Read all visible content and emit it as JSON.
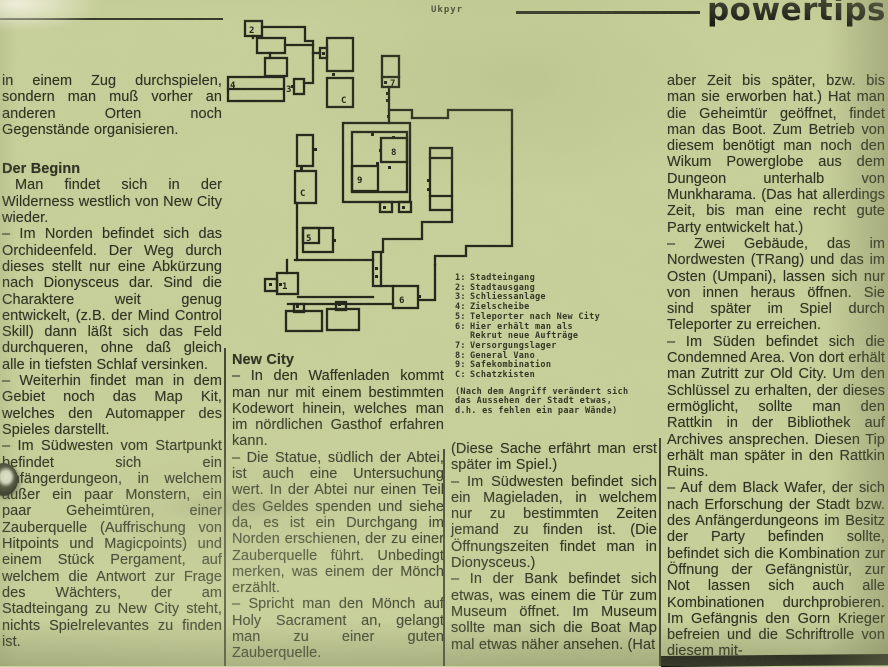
{
  "meta": {
    "map_caption": "Ukpyr",
    "section_title": "powertips"
  },
  "colors": {
    "paper": "#c9d19b",
    "ink": "#23261a",
    "map_ink": "#1b1d12"
  },
  "map": {
    "labels": {
      "r2": "2",
      "r3": "3",
      "r4": "4",
      "c_top": "C",
      "r7": "7",
      "r8": "8",
      "r9": "9",
      "c_mid": "C",
      "r5": "5",
      "r1": "1",
      "r6": "6"
    }
  },
  "legend": {
    "items": [
      {
        "k": "1:",
        "t": "Stadteingang"
      },
      {
        "k": "2:",
        "t": "Stadtausgang"
      },
      {
        "k": "3:",
        "t": "Schliessanlage"
      },
      {
        "k": "4:",
        "t": "Zielscheibe"
      },
      {
        "k": "5:",
        "t": "Teleporter nach New City"
      },
      {
        "k": "6:",
        "t": "Hier erhält man als"
      },
      {
        "k": "",
        "t": "Rekrut neue Aufträge"
      },
      {
        "k": "7:",
        "t": "Versorgungslager"
      },
      {
        "k": "8:",
        "t": "General Vano"
      },
      {
        "k": "9:",
        "t": "Safekombination"
      },
      {
        "k": "C:",
        "t": "Schatzkisten"
      }
    ],
    "note": [
      "(Nach dem Angriff verändert sich",
      "das Aussehen der Stadt etwas,",
      "d.h. es fehlen ein paar Wände)"
    ]
  },
  "columns": {
    "c1": {
      "blocks": [
        {
          "text": "in einem Zug durchspielen, sondern man muß vorher an anderen Orten noch Gegenstände organisieren."
        },
        {
          "text": "Der Beginn"
        },
        {
          "text": "Man findet sich in der Wilderness westlich von New City wieder."
        },
        {
          "text": "– Im Norden befindet sich das Orchideenfeld. Der Weg durch dieses stellt nur eine Abkürzung nach Dionysceus dar. Sind die Charaktere weit genug entwickelt, (z.B. der Mind Control Skill) dann läßt sich das Feld durchqueren, ohne daß gleich alle in tiefsten Schlaf versinken."
        },
        {
          "text": "– Weiterhin findet man in dem Gebiet noch das Map Kit, welches den Automapper des Spieles darstellt."
        },
        {
          "text": "– Im Südwesten vom Startpunkt befindet sich ein Anfängerdungeon, in welchem außer ein paar Monstern, ein paar Geheimtüren, einer Zauberquelle (Auffrischung von Hitpoints und Magicpoints) und einem Stück Pergament, auf welchem die Antwort zur Frage des Wächters, der am Stadteingang zu New City steht, nichts Spielrelevantes zu finden ist."
        }
      ]
    },
    "c2": {
      "blocks": [
        {
          "text": "New City"
        },
        {
          "text": "– In den Waffenladen kommt man nur mit einem bestimmten Kodewort hinein, welches man im nördlichen Gasthof erfahren kann."
        },
        {
          "text": "– Die Statue, südlich der Abtei, ist auch eine Untersuchung wert. In der Abtei nur einen Teil des Geldes spenden und siehe da, es ist ein Durchgang im Norden erschienen, der zu einer Zauberquelle führt. Unbedingt merken, was einem der Mönch erzählt."
        },
        {
          "text": "– Spricht man den Mönch auf Holy Sacrament an, gelangt man zu einer guten Zauberquelle."
        }
      ]
    },
    "c3": {
      "blocks": [
        {
          "text": "(Diese Sache erfährt man erst später im Spiel.)"
        },
        {
          "text": "– Im Südwesten befindet sich ein Magieladen, in welchem nur zu bestimmten Zeiten jemand zu finden ist. (Die Öffnungszeiten findet man in Dionysceus.)"
        },
        {
          "text": "– In der Bank befindet sich etwas, was einem die Tür zum Museum öffnet. Im Museum sollte man sich die Boat Map mal etwas näher ansehen. (Hat"
        }
      ]
    },
    "c4": {
      "blocks": [
        {
          "text": "aber Zeit bis später, bzw. bis man sie erworben hat.) Hat man die Geheimtür geöffnet, findet man das Boot. Zum Betrieb von diesem benötigt man noch den Wikum Powerglobe aus dem Dungeon unterhalb von Munkharama. (Das hat allerdings Zeit, bis man eine recht gute Party entwickelt hat.)"
        },
        {
          "text": "– Zwei Gebäude, das im Nordwesten (TRang) und das im Osten (Umpani), lassen sich nur von innen heraus öffnen. Sie sind später im Spiel durch Teleporter zu erreichen."
        },
        {
          "text": "– Im Süden befindet sich die Condemned Area. Von dort erhält man Zutritt zur Old City. Um den Schlüssel zu erhalten, der dieses ermöglicht, sollte man den Rattkin in der Bibliothek auf Archives ansprechen. Diesen Tip erhält man später in den Rattkin Ruins."
        },
        {
          "text": "– Auf dem Black Wafer, der sich nach Erforschung der Stadt bzw. des Anfängerdungeons im Besitz der Party befinden sollte, befindet sich die Kombination zur Öffnung der Gefängnistür, zur Not lassen sich auch alle Kombinationen durchprobieren. Im Gefängnis den Gorn Krieger befreien und die Schriftrolle von diesem mit-"
        }
      ]
    }
  }
}
